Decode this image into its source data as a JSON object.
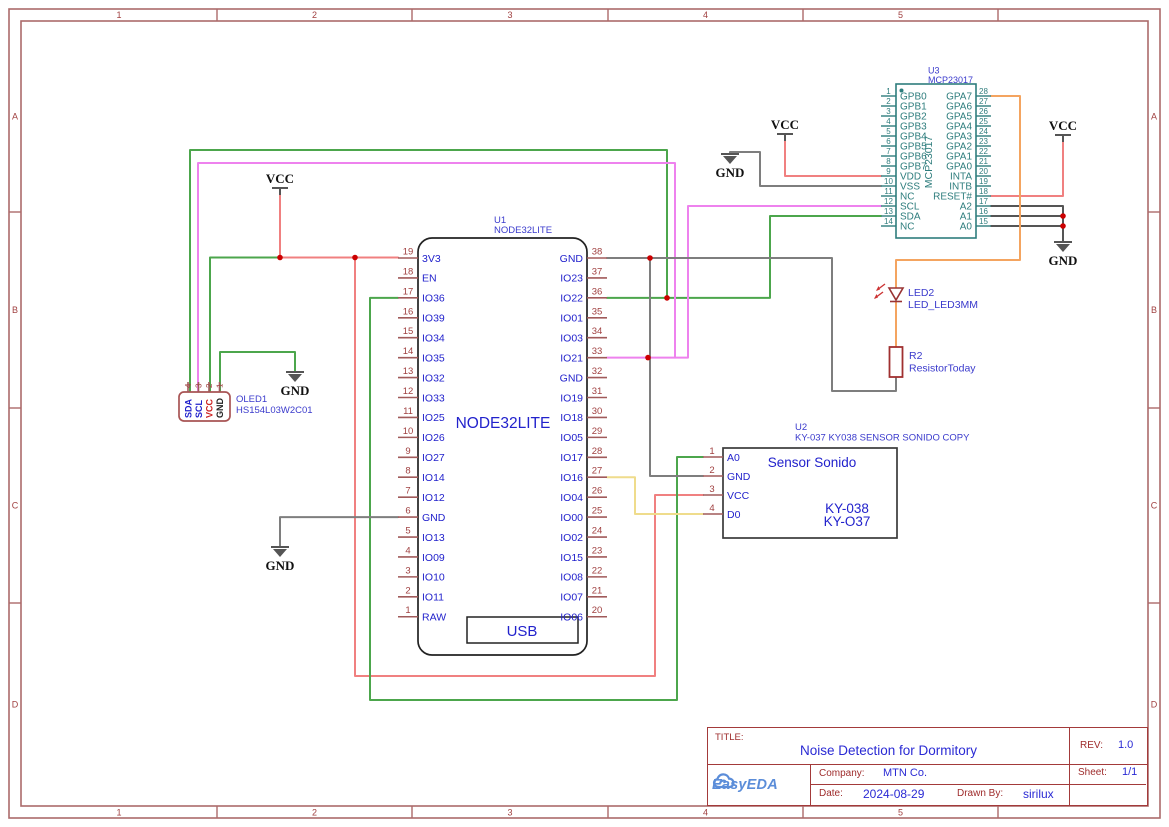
{
  "colors": {
    "wire_red": "#F08080",
    "wire_green": "#4CA64C",
    "wire_pink": "#EE82EE",
    "wire_orange": "#F4A460",
    "wire_yellow": "#EFDC8C",
    "wire_gray": "#7E7E7E",
    "wire_darkgray": "#555555",
    "pin": "#A05A5A",
    "pin_number": "#A04040",
    "name_blue": "#2222CC",
    "ref_blue": "#3A3ACC",
    "teal": "#2E7D7D",
    "junction": "#CC0000",
    "frame": "#AC6A6A",
    "frame_label": "#A04040",
    "outline_black": "#222222",
    "outline_dark": "#3A3A3A",
    "oled_outline": "#A85454",
    "led_red": "#993333",
    "resistor_red": "#A03030",
    "symbol_gray": "#555555",
    "power_text": "#111111"
  },
  "frame": {
    "columns": [
      "1",
      "2",
      "3",
      "4",
      "5"
    ],
    "rows": [
      "A",
      "B",
      "C",
      "D"
    ]
  },
  "power": {
    "vcc": "VCC",
    "gnd": "GND"
  },
  "u1": {
    "ref": "U1",
    "value": "NODE32LITE",
    "label": "NODE32LITE",
    "usb": "USB",
    "left_pins": [
      {
        "num": "19",
        "name": "3V3"
      },
      {
        "num": "18",
        "name": "EN"
      },
      {
        "num": "17",
        "name": "IO36"
      },
      {
        "num": "16",
        "name": "IO39"
      },
      {
        "num": "15",
        "name": "IO34"
      },
      {
        "num": "14",
        "name": "IO35"
      },
      {
        "num": "13",
        "name": "IO32"
      },
      {
        "num": "12",
        "name": "IO33"
      },
      {
        "num": "11",
        "name": "IO25"
      },
      {
        "num": "10",
        "name": "IO26"
      },
      {
        "num": "9",
        "name": "IO27"
      },
      {
        "num": "8",
        "name": "IO14"
      },
      {
        "num": "7",
        "name": "IO12"
      },
      {
        "num": "6",
        "name": "GND"
      },
      {
        "num": "5",
        "name": "IO13"
      },
      {
        "num": "4",
        "name": "IO09"
      },
      {
        "num": "3",
        "name": "IO10"
      },
      {
        "num": "2",
        "name": "IO11"
      },
      {
        "num": "1",
        "name": "RAW"
      }
    ],
    "right_pins": [
      {
        "num": "38",
        "name": "GND"
      },
      {
        "num": "37",
        "name": "IO23"
      },
      {
        "num": "36",
        "name": "IO22"
      },
      {
        "num": "35",
        "name": "IO01"
      },
      {
        "num": "34",
        "name": "IO03"
      },
      {
        "num": "33",
        "name": "IO21"
      },
      {
        "num": "32",
        "name": "GND"
      },
      {
        "num": "31",
        "name": "IO19"
      },
      {
        "num": "30",
        "name": "IO18"
      },
      {
        "num": "29",
        "name": "IO05"
      },
      {
        "num": "28",
        "name": "IO17"
      },
      {
        "num": "27",
        "name": "IO16"
      },
      {
        "num": "26",
        "name": "IO04"
      },
      {
        "num": "25",
        "name": "IO00"
      },
      {
        "num": "24",
        "name": "IO02"
      },
      {
        "num": "23",
        "name": "IO15"
      },
      {
        "num": "22",
        "name": "IO08"
      },
      {
        "num": "21",
        "name": "IO07"
      },
      {
        "num": "20",
        "name": "IO06"
      }
    ]
  },
  "u3": {
    "ref": "U3",
    "value": "MCP23017",
    "vertical_label": "MCP23017",
    "left_pins": [
      {
        "num": "1",
        "name": "GPB0"
      },
      {
        "num": "2",
        "name": "GPB1"
      },
      {
        "num": "3",
        "name": "GPB2"
      },
      {
        "num": "4",
        "name": "GPB3"
      },
      {
        "num": "5",
        "name": "GPB4"
      },
      {
        "num": "6",
        "name": "GPB5"
      },
      {
        "num": "7",
        "name": "GPB6"
      },
      {
        "num": "8",
        "name": "GPB7"
      },
      {
        "num": "9",
        "name": "VDD"
      },
      {
        "num": "10",
        "name": "VSS"
      },
      {
        "num": "11",
        "name": "NC"
      },
      {
        "num": "12",
        "name": "SCL"
      },
      {
        "num": "13",
        "name": "SDA"
      },
      {
        "num": "14",
        "name": "NC"
      }
    ],
    "right_pins": [
      {
        "num": "28",
        "name": "GPA7"
      },
      {
        "num": "27",
        "name": "GPA6"
      },
      {
        "num": "26",
        "name": "GPA5"
      },
      {
        "num": "25",
        "name": "GPA4"
      },
      {
        "num": "24",
        "name": "GPA3"
      },
      {
        "num": "23",
        "name": "GPA2"
      },
      {
        "num": "22",
        "name": "GPA1"
      },
      {
        "num": "21",
        "name": "GPA0"
      },
      {
        "num": "20",
        "name": "INTA"
      },
      {
        "num": "19",
        "name": "INTB"
      },
      {
        "num": "18",
        "name": "RESET#"
      },
      {
        "num": "17",
        "name": "A2"
      },
      {
        "num": "16",
        "name": "A1"
      },
      {
        "num": "15",
        "name": "A0"
      }
    ]
  },
  "u2": {
    "ref": "U2",
    "value": "KY-037 KY038 SENSOR SONIDO COPY",
    "title": "Sensor Sonido",
    "model1": "KY-038",
    "model2": "KY-O37",
    "pins": [
      {
        "num": "1",
        "name": "A0"
      },
      {
        "num": "2",
        "name": "GND"
      },
      {
        "num": "3",
        "name": "VCC"
      },
      {
        "num": "4",
        "name": "D0"
      }
    ]
  },
  "oled": {
    "ref": "OLED1",
    "value": "HS154L03W2C01",
    "pins": [
      {
        "num": "4",
        "name": "SDA",
        "color": "#2222CC"
      },
      {
        "num": "3",
        "name": "SCL",
        "color": "#2222CC"
      },
      {
        "num": "2",
        "name": "VCC",
        "color": "#CC2222"
      },
      {
        "num": "1",
        "name": "GND",
        "color": "#222222"
      }
    ]
  },
  "led": {
    "ref": "LED2",
    "value": "LED_LED3MM"
  },
  "r2": {
    "ref": "R2",
    "value": "ResistorToday"
  },
  "title_block": {
    "title_label": "TITLE:",
    "title": "Noise Detection for Dormitory",
    "rev_label": "REV:",
    "rev": "1.0",
    "company_label": "Company:",
    "company": "MTN Co.",
    "sheet_label": "Sheet:",
    "sheet": "1/1",
    "date_label": "Date:",
    "date": "2024-08-29",
    "drawn_by_label": "Drawn By:",
    "drawn_by": "sirilux",
    "logo": "EasyEDA"
  }
}
